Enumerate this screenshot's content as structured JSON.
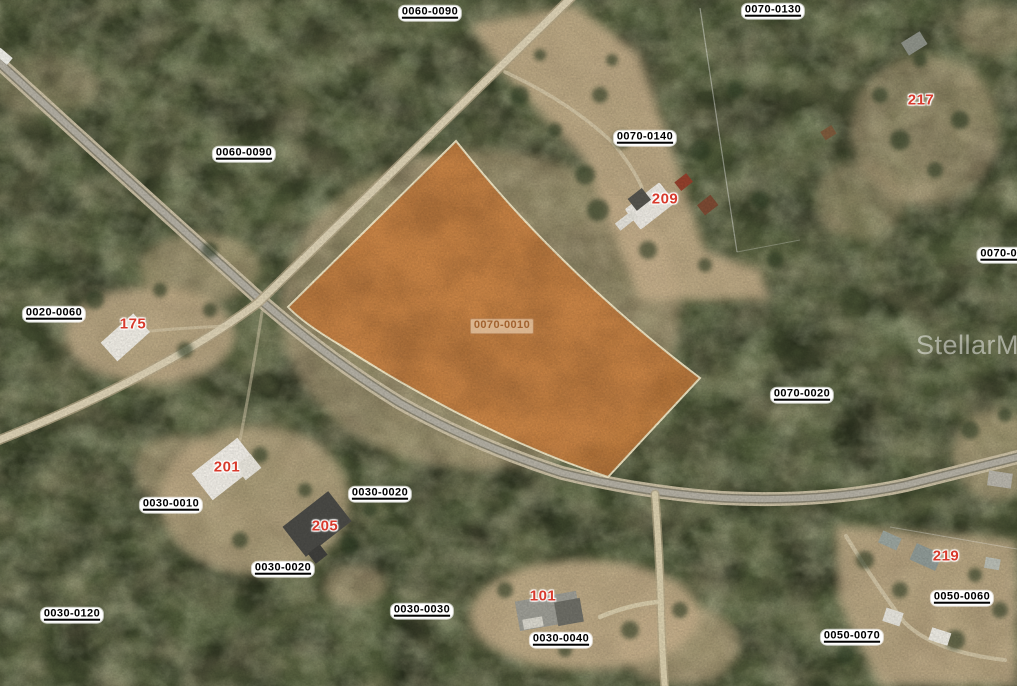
{
  "map": {
    "watermark": "StellarMLS",
    "highlighted_parcel": {
      "label": "0070-0010",
      "fill_color": "#d0823f",
      "outline_color": "#f6ecca"
    },
    "parcel_labels": [
      {
        "text": "0060-0090"
      },
      {
        "text": "0070-0130"
      },
      {
        "text": "0070-0140"
      },
      {
        "text": "0060-0090"
      },
      {
        "text": "0020-0060"
      },
      {
        "text": "0070-00"
      },
      {
        "text": "0070-0020"
      },
      {
        "text": "0030-0010"
      },
      {
        "text": "0030-0020"
      },
      {
        "text": "0030-0020"
      },
      {
        "text": "0030-0120"
      },
      {
        "text": "0030-0030"
      },
      {
        "text": "0030-0040"
      },
      {
        "text": "0050-0060"
      },
      {
        "text": "0050-0070"
      }
    ],
    "address_labels": [
      {
        "text": "175"
      },
      {
        "text": "201"
      },
      {
        "text": "205"
      },
      {
        "text": "209"
      },
      {
        "text": "217"
      },
      {
        "text": "219"
      },
      {
        "text": "101"
      }
    ],
    "colors": {
      "highlight_orange": "#d0823f",
      "parcel_label_bg": "#ffffff",
      "parcel_label_text": "#000000",
      "address_label_text": "#d73a2c",
      "road_asphalt": "#b3afa3",
      "road_dirt": "#dcd1b4",
      "forest_green": "#4f5a39",
      "sand": "#c9b28d"
    }
  }
}
